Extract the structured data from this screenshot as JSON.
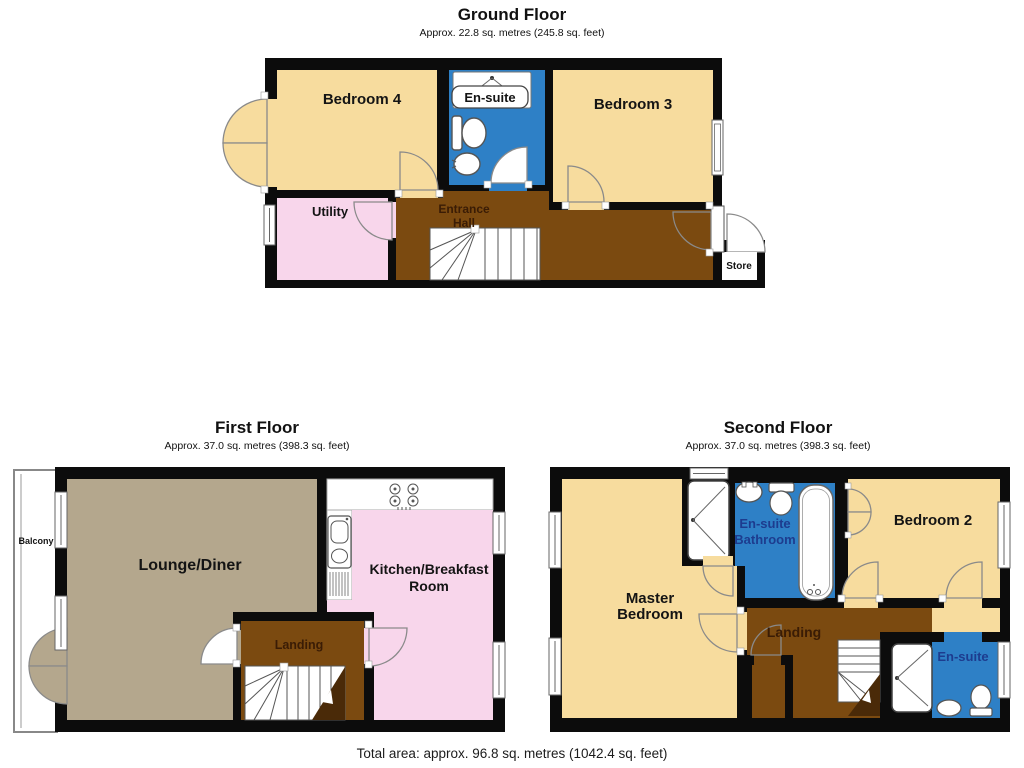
{
  "colors": {
    "room_cream": "#F7DC9E",
    "wet_room_blue": "#2E80C6",
    "hall_brown": "#7B4A10",
    "utility_pink": "#F8D6EB",
    "lounge_taupe": "#B4A78D",
    "stair_wedge_brown": "#4a2a08",
    "wall_black": "#0c0c0c",
    "ensuite_label_navy": "#1d3c8f"
  },
  "ground_floor": {
    "title": "Ground Floor",
    "subtitle": "Approx. 22.8 sq. metres (245.8 sq. feet)",
    "bedroom4": "Bedroom 4",
    "ensuite": "En-suite",
    "bedroom3": "Bedroom 3",
    "utility": "Utility",
    "entrance_hall_line1": "Entrance",
    "entrance_hall_line2": "Hall",
    "store": "Store"
  },
  "first_floor": {
    "title": "First Floor",
    "subtitle": "Approx. 37.0 sq. metres (398.3 sq. feet)",
    "balcony": "Balcony",
    "lounge": "Lounge/Diner",
    "kitchen_line1": "Kitchen/Breakfast",
    "kitchen_line2": "Room",
    "landing": "Landing"
  },
  "second_floor": {
    "title": "Second Floor",
    "subtitle": "Approx. 37.0 sq. metres (398.3 sq. feet)",
    "master_line1": "Master",
    "master_line2": "Bedroom",
    "ensuite_bathroom_line1": "En-suite",
    "ensuite_bathroom_line2": "Bathroom",
    "bedroom2": "Bedroom 2",
    "landing": "Landing",
    "ensuite": "En-suite"
  },
  "footer": {
    "total_area": "Total area: approx. 96.8 sq. metres (1042.4 sq. feet)"
  }
}
